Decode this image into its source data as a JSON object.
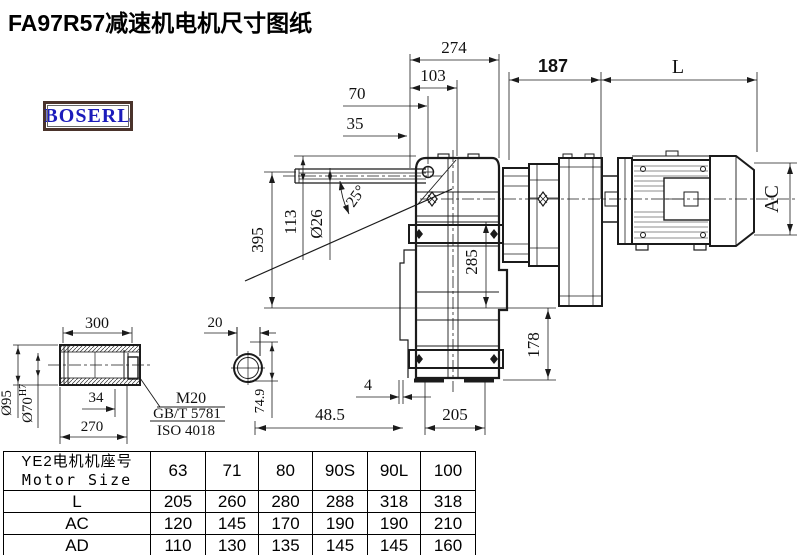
{
  "page": {
    "title": "FA97R57减速机电机尺寸图纸",
    "logo_text": "BOSERL"
  },
  "drawing": {
    "dims": {
      "overall_width": "274",
      "w103": "103",
      "w70": "70",
      "w35": "35",
      "motor_187": "187",
      "motor_len": "L",
      "motor_height": "AC",
      "h395": "395",
      "h113": "113",
      "rod_dia": "Ø26",
      "swing_angle": "25°",
      "h285": "285",
      "h178": "178",
      "gap4": "4",
      "w48_5": "48.5",
      "w205": "205",
      "sleeve_len": "300",
      "sleeve_od": "Ø95",
      "bore": "Ø70",
      "bore_tol": "H7",
      "w34": "34",
      "w270": "270",
      "rod_flat": "20",
      "h74_9": "74.9",
      "thread": "M20",
      "std_gb": "GB/T 5781",
      "std_iso": "ISO 4018"
    }
  },
  "table": {
    "header": {
      "line1": "YE2电机机座号",
      "line2": "Motor Size"
    },
    "columns": [
      "63",
      "71",
      "80",
      "90S",
      "90L",
      "100"
    ],
    "rows": [
      {
        "label": "L",
        "values": [
          "205",
          "260",
          "280",
          "288",
          "318",
          "318"
        ]
      },
      {
        "label": "AC",
        "values": [
          "120",
          "145",
          "170",
          "190",
          "190",
          "210"
        ]
      },
      {
        "label": "AD",
        "values": [
          "110",
          "130",
          "135",
          "145",
          "145",
          "160"
        ]
      }
    ]
  }
}
